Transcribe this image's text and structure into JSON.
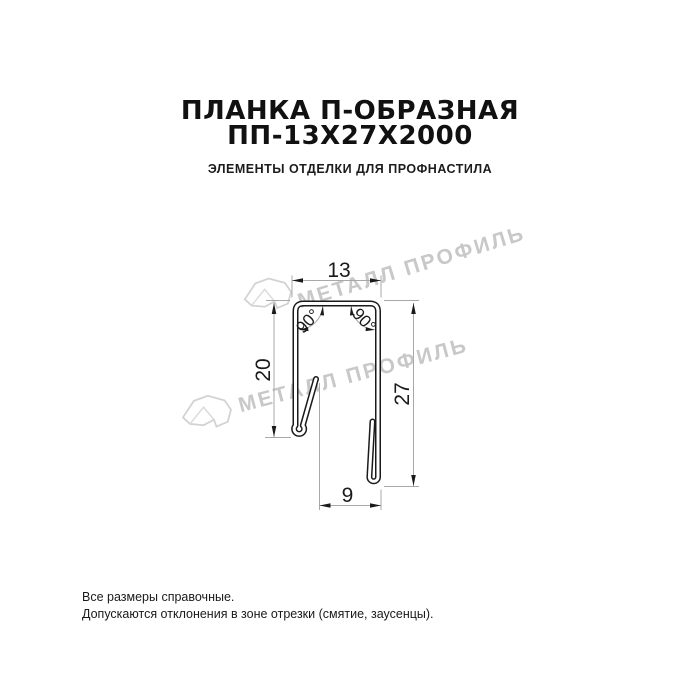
{
  "header": {
    "title_line1": "ПЛАНКА П-ОБРАЗНАЯ",
    "title_line2": "ПП-13Х27Х2000",
    "subtitle": "ЭЛЕМЕНТЫ ОТДЕЛКИ ДЛЯ ПРОФНАСТИЛА"
  },
  "drawing": {
    "dimensions": {
      "top_width": "13",
      "left_height": "20",
      "right_height": "27",
      "bottom_width": "9"
    },
    "angles": {
      "left": "90°",
      "right": "90°"
    }
  },
  "watermark": {
    "text": "МЕТАЛЛ ПРОФИЛЬ"
  },
  "footer": {
    "note1": "Все размеры справочные.",
    "note2": "Допускаются отклонения в зоне отрезки (смятие, заусенцы)."
  },
  "colors": {
    "drawing_line": "#1a1a1a",
    "dimension_line": "#a8a8a8",
    "watermark": "#c8c8c8",
    "text": "#111111"
  }
}
